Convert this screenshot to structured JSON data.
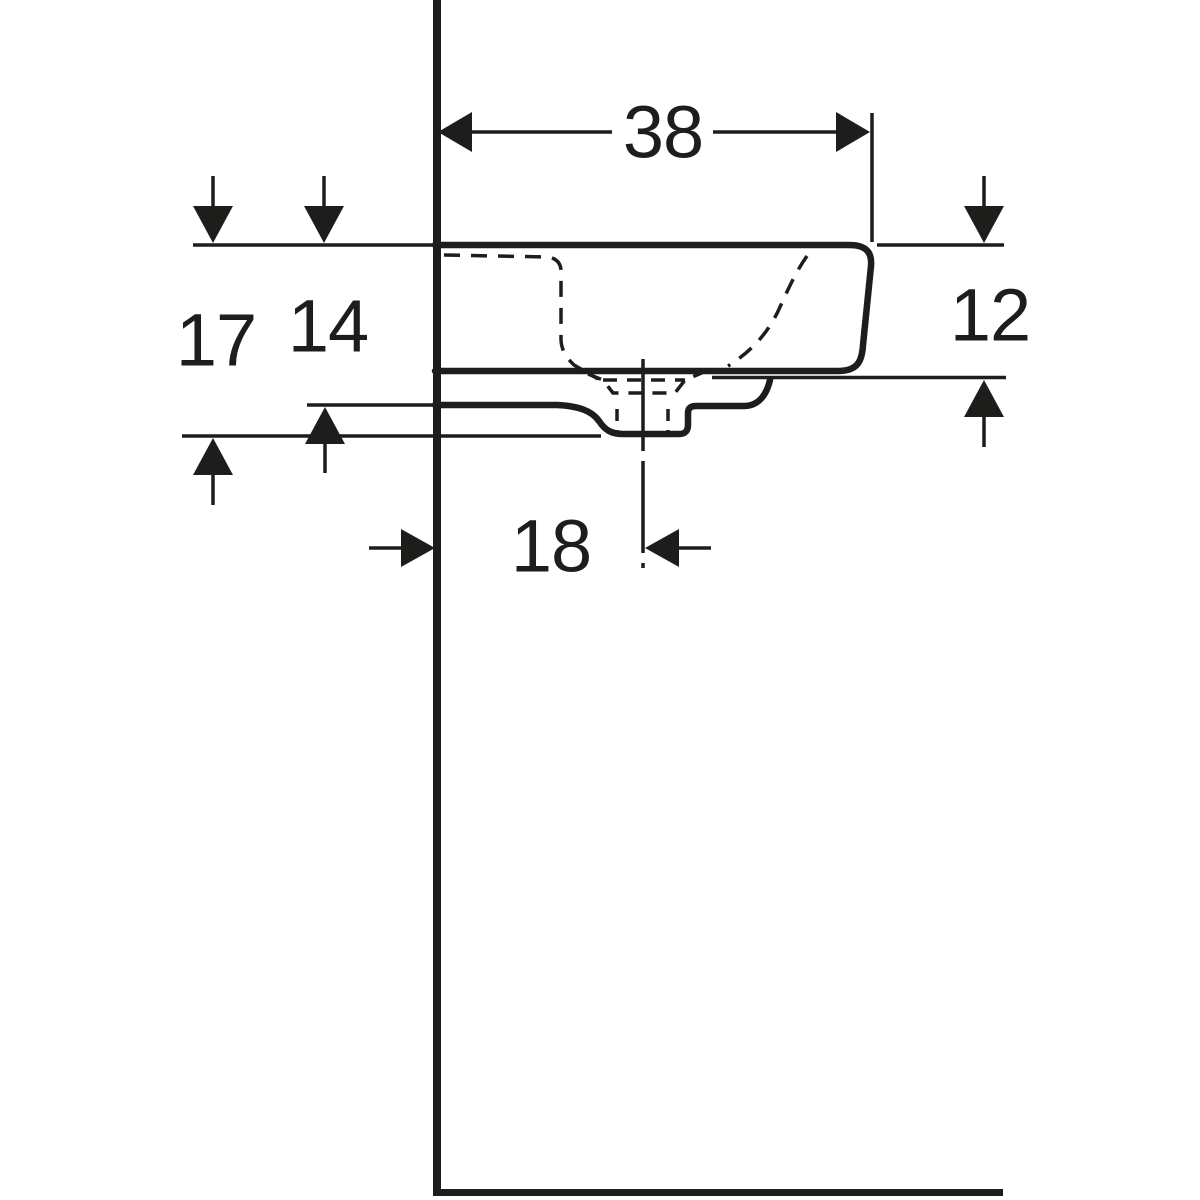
{
  "page": {
    "background": "#ffffff"
  },
  "drawing": {
    "subject": "wall-mounted handrinse washbasin, side elevation technical drawing",
    "line_color": "#1d1d1b",
    "dimensions": {
      "depth_from_wall": {
        "value": "38"
      },
      "overall_height": {
        "value": "17"
      },
      "height_to_underside": {
        "value": "14"
      },
      "front_edge_height": {
        "value": "12"
      },
      "drain_centre_offset": {
        "value": "18"
      }
    }
  }
}
